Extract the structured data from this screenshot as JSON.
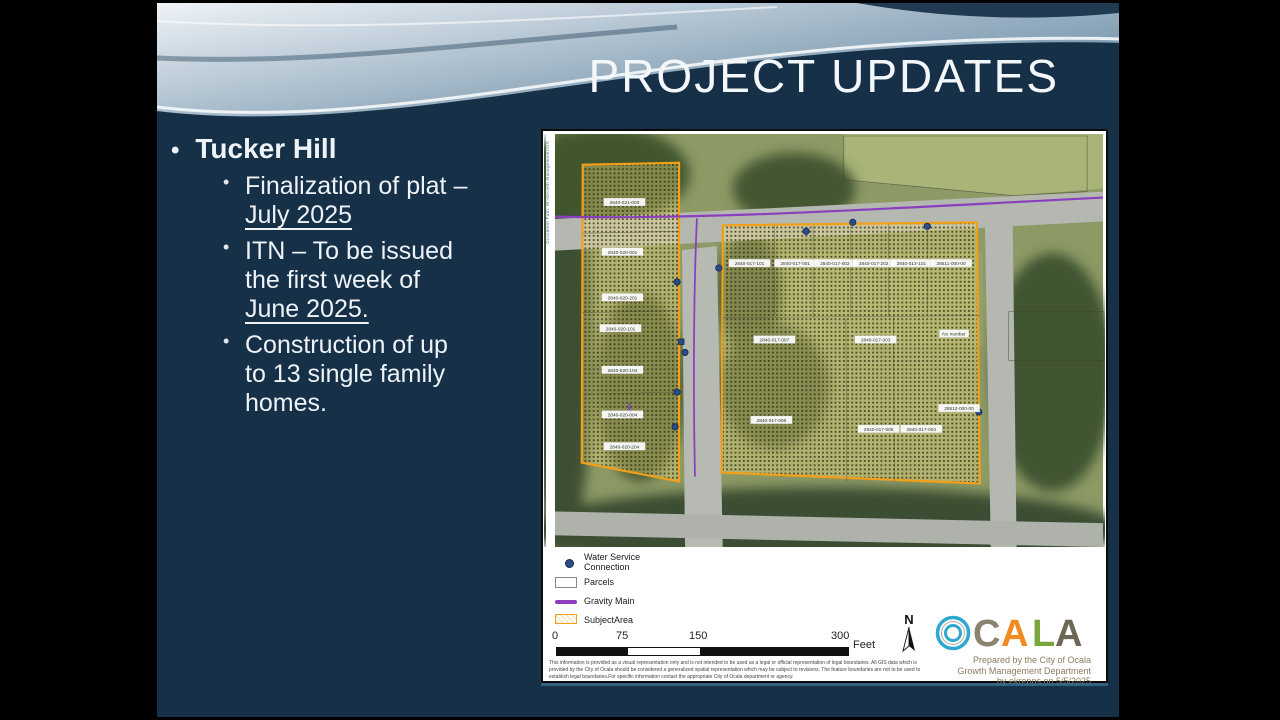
{
  "slide": {
    "title": "PROJECT UPDATES",
    "heading": "Tucker Hill",
    "sub_bullets": [
      {
        "lines": [
          {
            "t": "Finalization of plat –",
            "u": false
          },
          {
            "t": "July 2025",
            "u": true
          }
        ]
      },
      {
        "lines": [
          {
            "t": "ITN – To be issued",
            "u": false
          },
          {
            "t": "the first week of",
            "u": false
          },
          {
            "t": "June 2025.",
            "u": true
          }
        ]
      },
      {
        "lines": [
          {
            "t": "Construction of up",
            "u": false
          },
          {
            "t": "to 13 single family",
            "u": false
          },
          {
            "t": "homes.",
            "u": false
          }
        ]
      }
    ]
  },
  "map": {
    "margin_text": "Document Path: W:\\Growth Management\\GIS",
    "labels_left": [
      "2840-021-003",
      "2840-020-001",
      "2840-020-201",
      "2840-020-101",
      "2840-020-104",
      "2840-020-004",
      "2840-020-204"
    ],
    "labels_right_top": [
      "2840-017-101",
      "2840-017-001",
      "2840-017-002",
      "2840-017-202",
      "2840-013-101",
      "28511-000-00"
    ],
    "labels_right_mid": [
      "2840-017-007",
      "2840-017-003",
      "No number"
    ],
    "labels_right_bottom": [
      "2840-017-008",
      "2840-017-005",
      "2840-017-004",
      "28512-000-00"
    ],
    "legend": {
      "water1": "Water Service",
      "water2": "Connection",
      "parcels": "Parcels",
      "gravity": "Gravity Main",
      "subject": "SubjectArea"
    },
    "scale": {
      "t0": "0",
      "t1": "75",
      "t2": "150",
      "t3": "300",
      "unit": "Feet"
    },
    "north": "N",
    "logo": {
      "letters": [
        {
          "ch": "C",
          "color": "#8b8272"
        },
        {
          "ch": "A",
          "color": "#f08a21"
        },
        {
          "ch": "L",
          "color": "#79a73e"
        },
        {
          "ch": "A",
          "color": "#6e6657"
        }
      ],
      "ring_color": "#2fa8cf"
    },
    "attribution": [
      "Prepared by the City of Ocala",
      "Growth Management Department",
      "by ekrepps on 5/5/2025"
    ],
    "disclaimer": [
      "This information is provided as a visual representation only and is not intended to be used as a legal or official representation of legal boundaries. All GIS data which is",
      "provided by the City of Ocala should be considered a generalized spatial representation which may be subject to revisions.  The feature boundaries are not to be used to",
      "establish legal boundaries.For specific information contact the appropriate City of Ocala department or agency."
    ]
  },
  "colors": {
    "subject_orange": "#F2A01A",
    "gravity_purple": "#8B3FBF",
    "water_blue": "#2b4c85",
    "slide_navy": "#163048"
  }
}
